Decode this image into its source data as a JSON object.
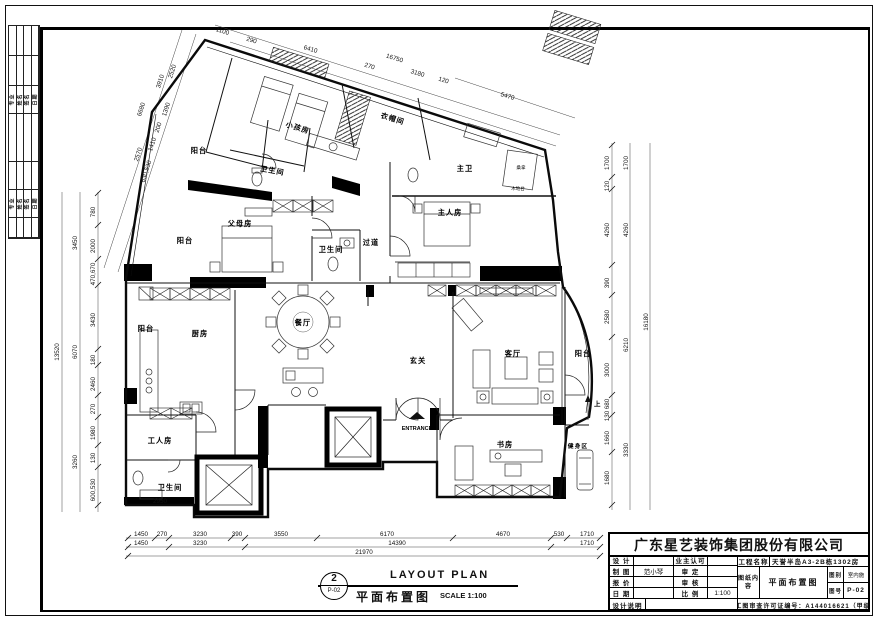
{
  "sheet": {
    "company": "广东星艺装饰集团股份有限公司",
    "permit": "施工图审查许可证编号：A144016621（甲级）"
  },
  "sidebar": {
    "row1": [
      "专业",
      "姓名",
      "签名",
      "日期"
    ],
    "row2": [
      "专业",
      "姓名",
      "签名",
      "日期"
    ]
  },
  "titleblock": {
    "design_label": "设 计",
    "design_value": "",
    "owner_label": "业主认可",
    "owner_value": "",
    "draft_label": "制 图",
    "draft_value": "范小琴",
    "approve_label": "审 定",
    "approve_value": "",
    "quote_label": "报 价",
    "quote_value": "",
    "check_label": "审 核",
    "check_value": "",
    "date_label": "日 期",
    "date_value": "",
    "scale_label": "比 例",
    "scale_value": "1:100",
    "note_label": "设计说明",
    "project_label": "工程名称",
    "project_value": "天誉半岛A3-2B栋1302房",
    "content_label": "图纸内容",
    "content_value": "平面布置图",
    "category_label": "图别",
    "category_value": "室内施",
    "sheetno_label": "图号",
    "sheetno_value": "P-02"
  },
  "stamp": {
    "number": "2",
    "ref": "P-02",
    "title_cn": "平面布置图",
    "title_en": "LAYOUT PLAN",
    "scale": "SCALE 1:100"
  },
  "plan": {
    "rooms": [
      "小孩房",
      "阳台",
      "卫生间",
      "衣帽间",
      "主卫",
      "桑拿",
      "木地台",
      "主人房",
      "父母房",
      "过道",
      "卫生间",
      "阳台",
      "厨房",
      "餐厅",
      "阳台",
      "玄关",
      "客厅",
      "阳台",
      "ENTRANCE",
      "工人房",
      "卫生间",
      "书房",
      "健身区",
      "上"
    ],
    "dims": {
      "top": [
        "1100",
        "290",
        "6410",
        "16750",
        "270",
        "3180",
        "120",
        "5470"
      ],
      "left_slant": [
        "2520",
        "3910",
        "6680",
        "1390",
        "200",
        "1410",
        "2570",
        "630,530"
      ],
      "left": [
        "780",
        "3450",
        "2000",
        "470,670",
        "3430",
        "180",
        "2460",
        "270",
        "1980",
        "130",
        "600,530",
        "6070",
        "3260",
        "13520"
      ],
      "right": [
        "1700",
        "120",
        "4260",
        "390",
        "2580",
        "3000",
        "680",
        "130",
        "1660",
        "1680",
        "1700",
        "4260",
        "6210",
        "3330",
        "16180"
      ],
      "bottom1": [
        "1450",
        "270",
        "3230",
        "390",
        "3550",
        "6170",
        "4670",
        "530",
        "1710"
      ],
      "bottom2": [
        "1450",
        "3230",
        "14390",
        "1710"
      ],
      "total": "21970",
      "extra": "2950"
    }
  }
}
